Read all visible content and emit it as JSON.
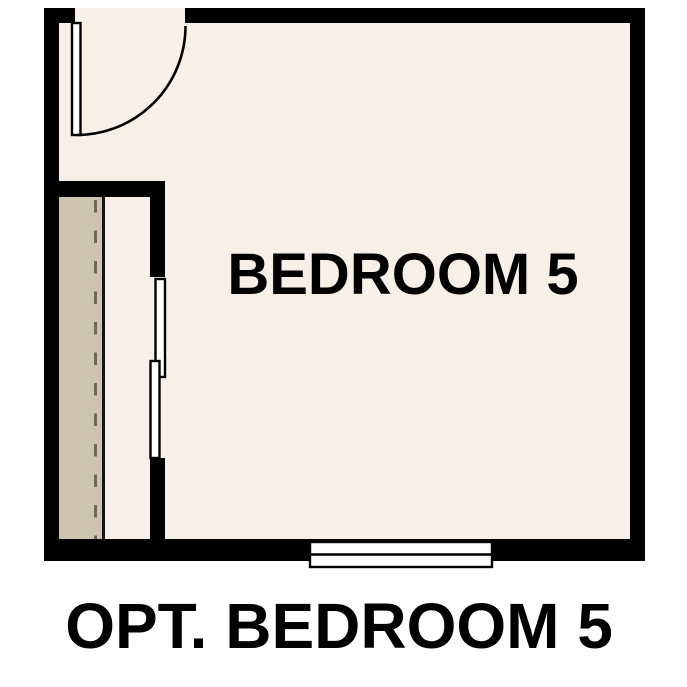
{
  "plan": {
    "room_label": "BEDROOM 5",
    "caption": "OPT. BEDROOM 5"
  },
  "colors": {
    "wall": "#000000",
    "floor": "#f7f0e6",
    "closet-shelf": "#cdc3ae",
    "shelf-edge": "#151515",
    "rod-dash": "#6f6757",
    "fixture-fill": "#ffffff",
    "line": "#000000",
    "text": "#000000",
    "background": "#ffffff"
  }
}
